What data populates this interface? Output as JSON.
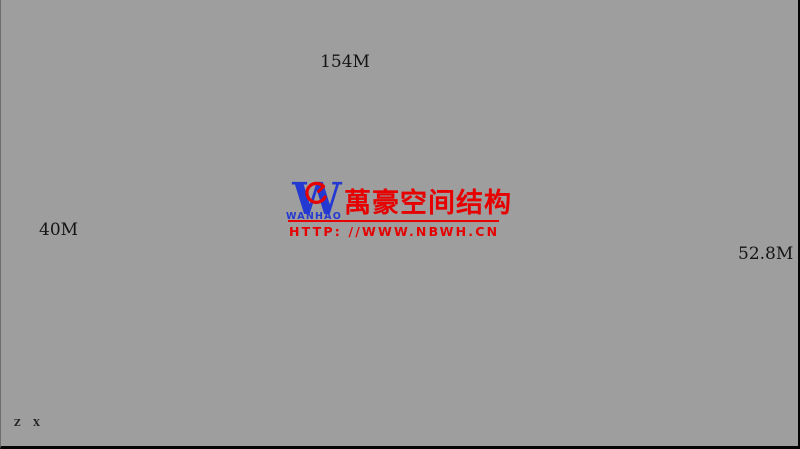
{
  "viewport": {
    "background": "#9e9e9e"
  },
  "drawing": {
    "line_color": "#2e2e2e",
    "thin_line": "#575757",
    "chord_color": "#2a2a2a",
    "spine_dark": "#191919",
    "cloud": "#eeeeee",
    "faint_line": "#b9b9b9",
    "dim_color": "#1a1a1a"
  },
  "dimensions": {
    "top": "154M",
    "left": "40M",
    "right": "52.8M"
  },
  "watermark": {
    "logo_letter": "W",
    "logo_text": "WANHAO",
    "brand_cn": "萬豪空间结构",
    "url": "HTTP: //WWW.NBWH.CN",
    "red": "#e60000",
    "blue": "#2438d2"
  },
  "axis": {
    "z": "Z",
    "x": "X"
  }
}
